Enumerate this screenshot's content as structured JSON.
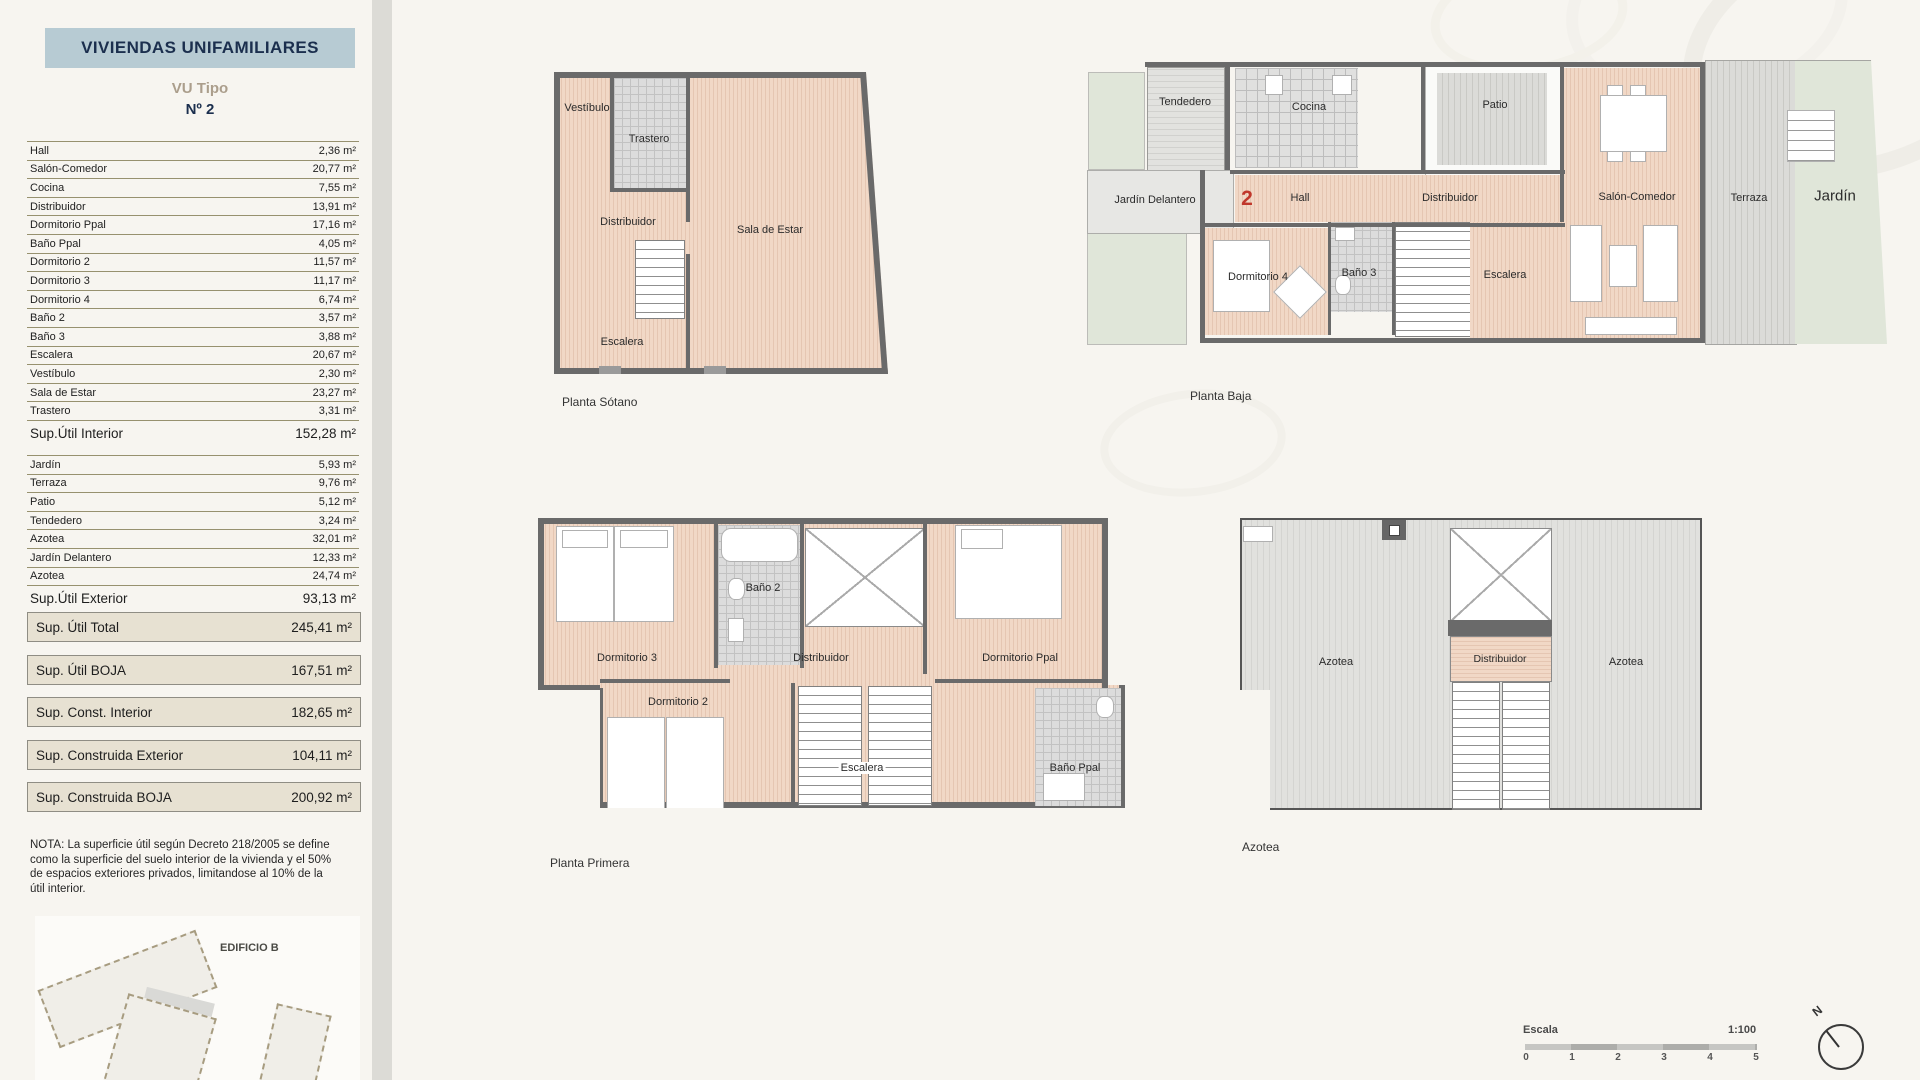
{
  "sidebar": {
    "title": "VIVIENDAS UNIFAMILIARES",
    "subtitle": "VU Tipo",
    "number": "Nº 2",
    "interior_rows": [
      {
        "label": "Hall",
        "value": "2,36 m²"
      },
      {
        "label": "Salón-Comedor",
        "value": "20,77 m²"
      },
      {
        "label": "Cocina",
        "value": "7,55 m²"
      },
      {
        "label": "Distribuidor",
        "value": "13,91 m²"
      },
      {
        "label": "Dormitorio Ppal",
        "value": "17,16 m²"
      },
      {
        "label": "Baño Ppal",
        "value": "4,05 m²"
      },
      {
        "label": "Dormitorio 2",
        "value": "11,57 m²"
      },
      {
        "label": "Dormitorio 3",
        "value": "11,17 m²"
      },
      {
        "label": "Dormitorio 4",
        "value": "6,74 m²"
      },
      {
        "label": "Baño 2",
        "value": "3,57 m²"
      },
      {
        "label": "Baño 3",
        "value": "3,88 m²"
      },
      {
        "label": "Escalera",
        "value": "20,67 m²"
      },
      {
        "label": "Vestíbulo",
        "value": "2,30 m²"
      },
      {
        "label": "Sala de Estar",
        "value": "23,27 m²"
      },
      {
        "label": "Trastero",
        "value": "3,31 m²"
      }
    ],
    "interior_total": {
      "label": "Sup.Útil Interior",
      "value": "152,28 m²"
    },
    "exterior_rows": [
      {
        "label": "Jardín",
        "value": "5,93 m²"
      },
      {
        "label": "Terraza",
        "value": "9,76 m²"
      },
      {
        "label": "Patio",
        "value": "5,12 m²"
      },
      {
        "label": "Tendedero",
        "value": "3,24 m²"
      },
      {
        "label": "Azotea",
        "value": "32,01 m²"
      },
      {
        "label": "Jardín Delantero",
        "value": "12,33 m²"
      },
      {
        "label": "Azotea",
        "value": "24,74 m²"
      }
    ],
    "exterior_total": {
      "label": "Sup.Útil Exterior",
      "value": "93,13 m²"
    },
    "summary_boxes": [
      {
        "label": "Sup. Útil Total",
        "value": "245,41 m²"
      },
      {
        "label": "Sup. Útil BOJA",
        "value": "167,51 m²"
      },
      {
        "label": "Sup. Const. Interior",
        "value": "182,65 m²"
      },
      {
        "label": "Sup. Construida Exterior",
        "value": "104,11 m²"
      },
      {
        "label": "Sup. Construida BOJA",
        "value": "200,92 m²"
      }
    ],
    "note": "NOTA: La superficie útil según Decreto 218/2005 se define como la superficie del suelo interior de la vivienda y el 50% de espacios exteriores privados, limitandose al 10% de la útil interior.",
    "site_plan_label": "EDIFICIO B"
  },
  "plans": {
    "sotano": {
      "caption": "Planta Sótano",
      "rooms": [
        "Vestíbulo",
        "Trastero",
        "Distribuidor",
        "Sala de Estar",
        "Escalera"
      ]
    },
    "baja": {
      "caption": "Planta Baja",
      "unit_number": "2",
      "rooms": [
        "Tendedero",
        "Cocina",
        "Patio",
        "Jardín Delantero",
        "Hall",
        "Distribuidor",
        "Salón-Comedor",
        "Terraza",
        "Jardín",
        "Dormitorio 4",
        "Baño 3",
        "Escalera"
      ]
    },
    "primera": {
      "caption": "Planta Primera",
      "rooms": [
        "Dormitorio 3",
        "Baño 2",
        "Distribuidor",
        "Dormitorio 2",
        "Escalera",
        "Dormitorio Ppal",
        "Baño Ppal"
      ]
    },
    "azotea": {
      "caption": "Azotea",
      "rooms": [
        "Azotea",
        "Distribuidor",
        "Azotea"
      ]
    }
  },
  "scale": {
    "label": "Escala",
    "ratio": "1:100",
    "ticks": [
      "0",
      "1",
      "2",
      "3",
      "4",
      "5"
    ]
  },
  "compass": {
    "label": "N"
  },
  "colors": {
    "header_bg": "#b7cbd3",
    "header_text": "#1b2f4e",
    "subtitle_text": "#ab9e8c",
    "table_line": "#97916f",
    "summary_box_bg": "#e7e1d2",
    "wall": "#6a6a6a",
    "wood_floor": "#f0d7c5",
    "tile_floor": "#e0e0df",
    "deck_floor": "#dbdbd8",
    "grass": "#e0e6d9",
    "unit_number_red": "#c0372b"
  }
}
